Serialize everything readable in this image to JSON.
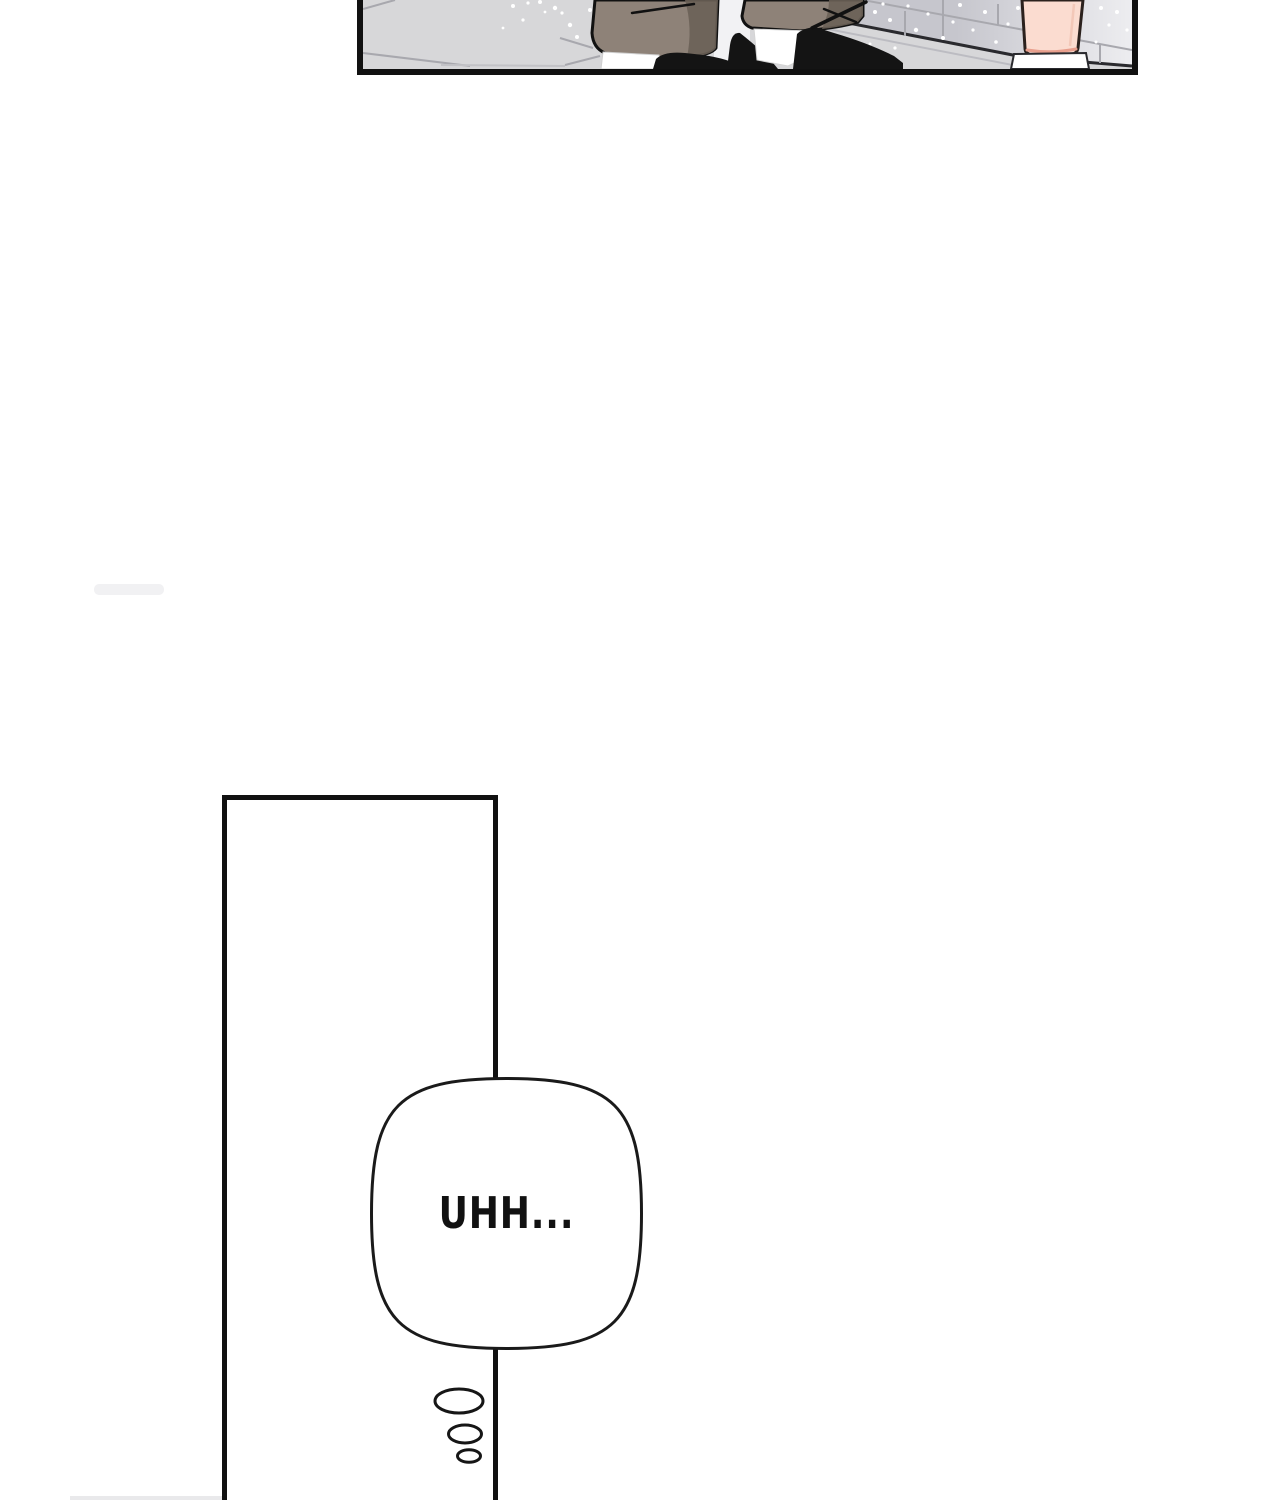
{
  "bubble": {
    "text": "UHH..."
  },
  "colors": {
    "ink": "#111111",
    "floor": "#d7d7d9",
    "wall-dark": "#c6c6cd",
    "wall-light": "#ededf0",
    "pants": "#8e8278",
    "pants-shadow": "#6a6057",
    "garment-black": "#141414",
    "sock": "#ffffff",
    "skin": "#fbdcd0",
    "skin-shadow": "#e89f8d",
    "tile-line": "#a8a8ae",
    "sparkle": "#ffffff",
    "baseboard-line": "#2a2a2e"
  }
}
